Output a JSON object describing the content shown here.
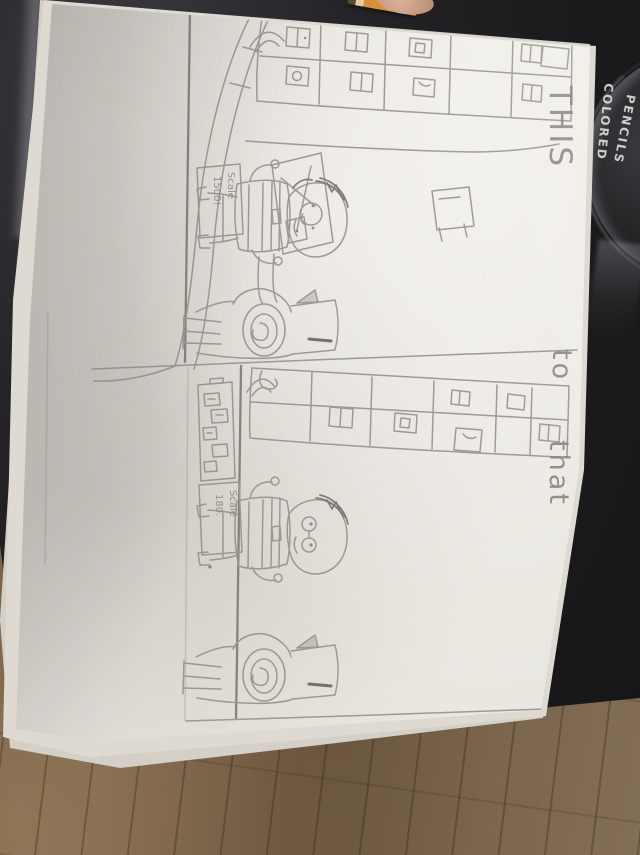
{
  "photo": {
    "handwriting": {
      "word1": "THIS",
      "word2": "to",
      "word3": "that"
    },
    "panel1_sign": {
      "line1": "Scale",
      "line2": "1500!"
    },
    "panel2_sign": {
      "line1": "Scale",
      "line2": "180."
    },
    "pencil_tin": {
      "line1": "COLORED",
      "line2": "PENCILS"
    },
    "colors": {
      "paper": "#eae7e1",
      "table_dark": "#1b1b1d",
      "wood_floor": "#6f5943",
      "pencil_stroke": "#8f8c87",
      "tin_text": "#dcdcdc",
      "pencil_body_orange": "#d98f35"
    },
    "drawing_elements": [
      "storefront-shelf-grid",
      "curved-wall-with-poster",
      "person-holding-scale-sign",
      "race-car-with-spiral-wheel",
      "menu-board",
      "stool"
    ]
  }
}
